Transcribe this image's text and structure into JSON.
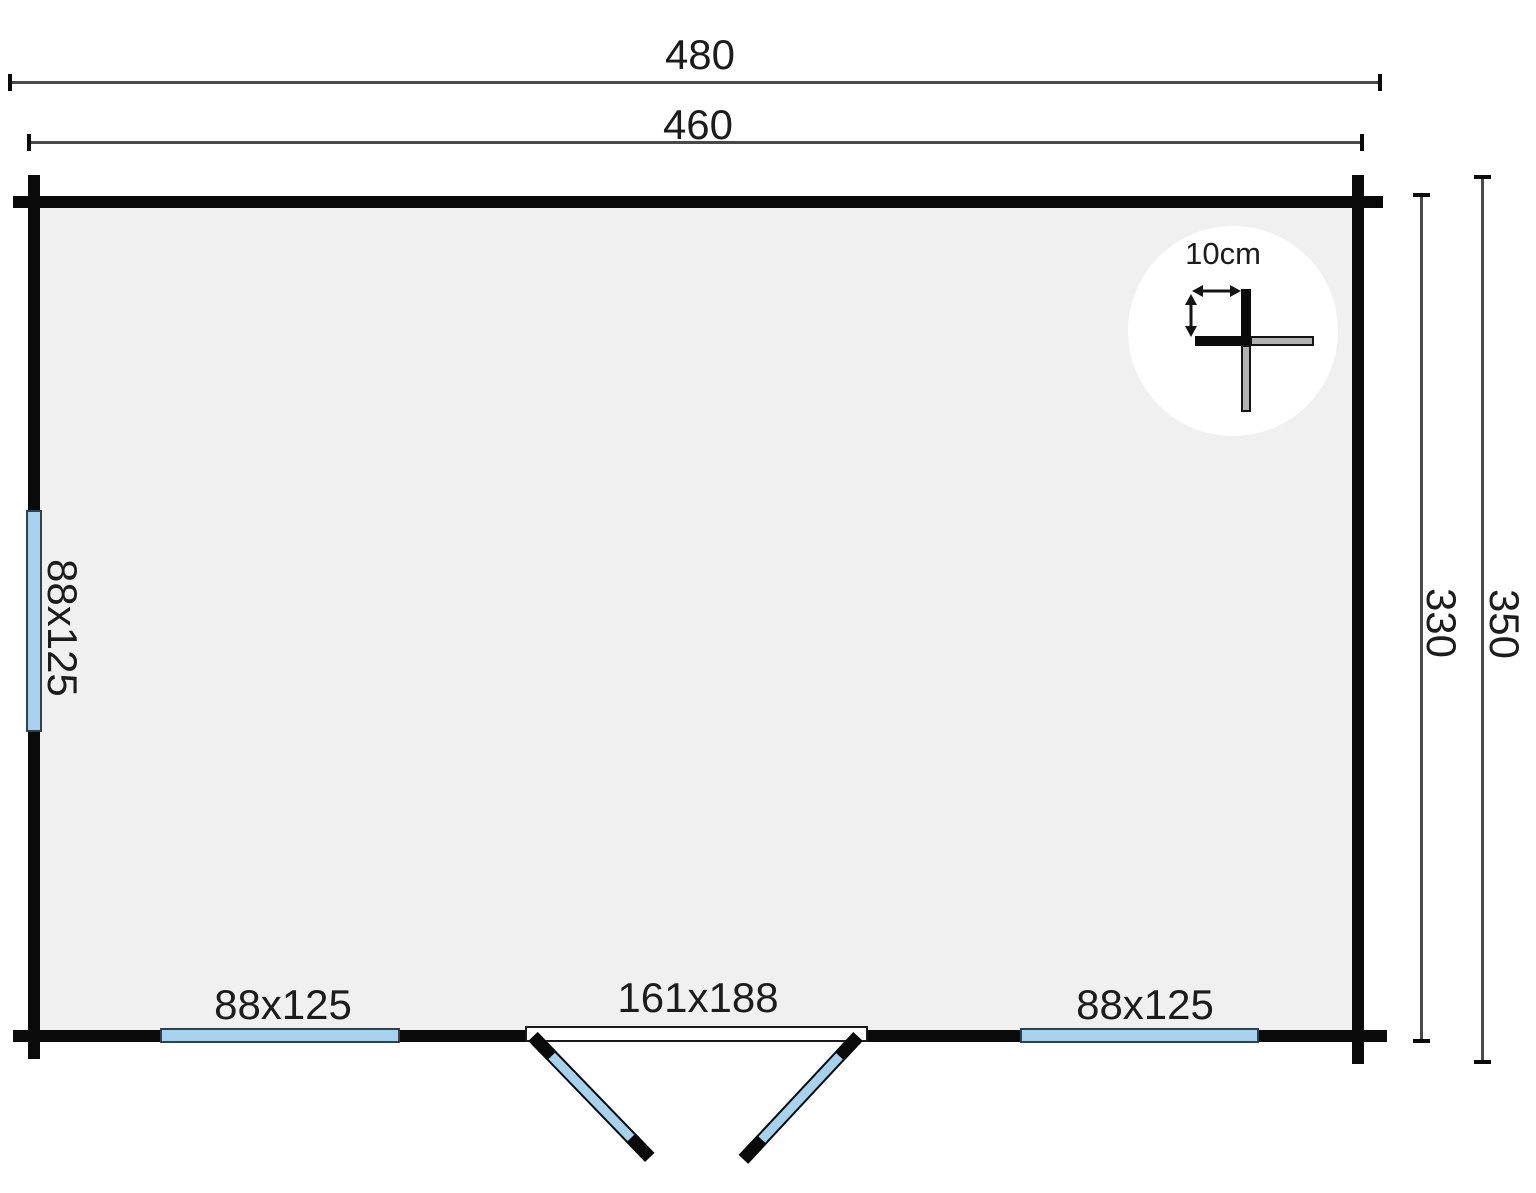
{
  "plan": {
    "dimensions": {
      "outer_width": "480",
      "inner_width": "460",
      "inner_depth": "330",
      "outer_depth": "350"
    },
    "openings": {
      "left_window": "88x125",
      "bottom_left_window": "88x125",
      "double_door": "161x188",
      "bottom_right_window": "88x125"
    },
    "detail": {
      "wall_thickness": "10cm"
    },
    "colors": {
      "wall": "#0a0a0a",
      "interior": "#f0f0f1",
      "window_fill": "#a7d2ee",
      "window_border": "#33414b",
      "dim_line": "#494949",
      "log_gray": "#b2b2b2",
      "text": "#1c1c1c"
    }
  }
}
